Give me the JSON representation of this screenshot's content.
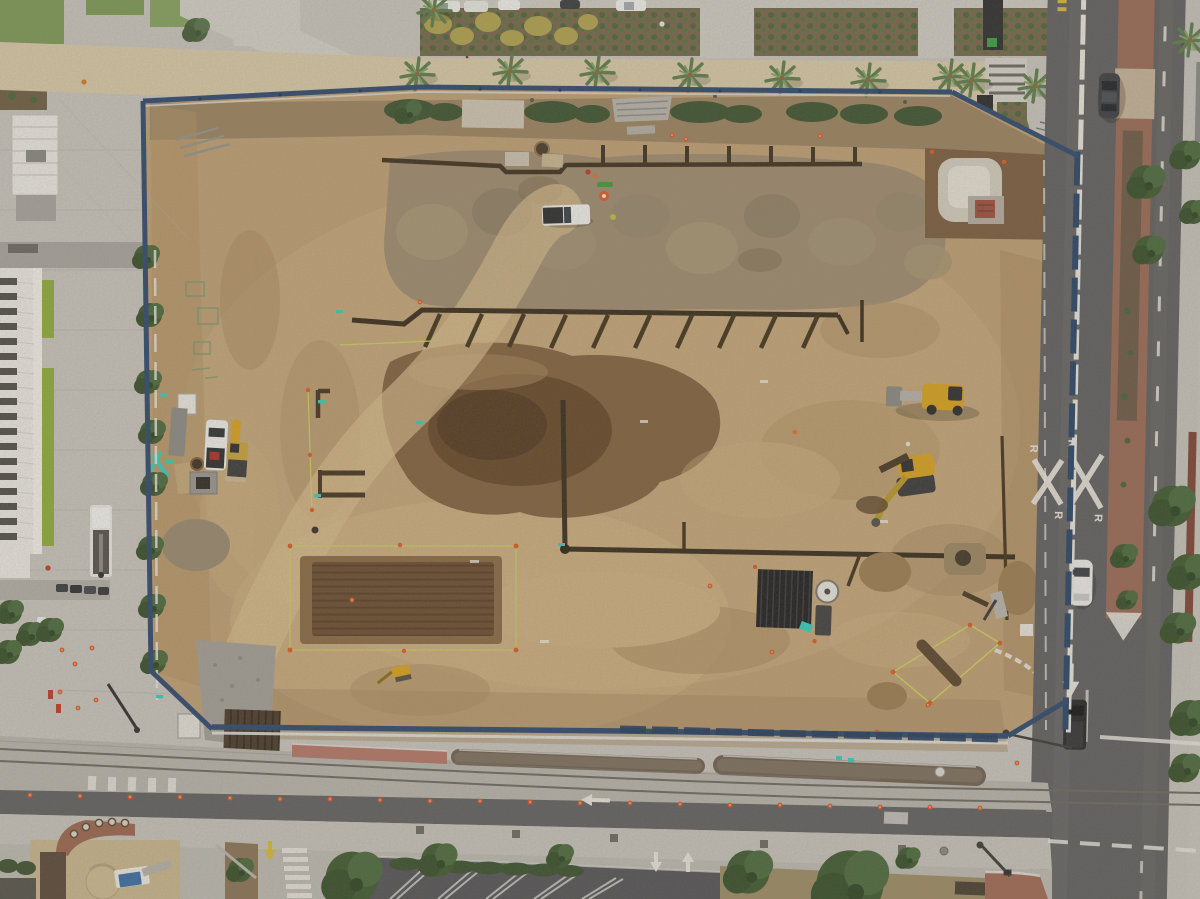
{
  "scene": {
    "title": "Aerial drone view of an urban construction excavation site",
    "description": "Top-down photo: a large graded dirt lot enclosed by a blue construction fence. A palm-lined paver promenade and garden beds run along the top, a concrete civic plaza with a white slatted-roof building sits on the left, a north-south street with a red brick median runs down the right side, and a light-rail track corridor with a parallel roadway crosses the bottom. Excavators, trenches with soldier piles, spoil piles, survey string lines and scattered equipment cover the site.",
    "markings": {
      "railroad_crossing_letter": "R"
    },
    "palette": {
      "dirt": "#bfa076",
      "dirt_dark": "#7a5b3c",
      "pit": "#6b4e33",
      "plaza_concrete": "#c8c6c0",
      "paver_tan": "#d9cbab",
      "asphalt": "#616163",
      "brick_median": "#9a6a58",
      "pink_pavers": "#b5786b",
      "fence_blue": "#2e4a72",
      "barrier_white": "#e9e7e1",
      "track_concrete": "#b7b5af",
      "grass": "#7c9a58",
      "hedge": "#3d5432",
      "palm": "#6f8f5f",
      "machine_yellow": "#d9a322",
      "cone_orange": "#e05a28",
      "teal_marker": "#35cfc0",
      "survey_yellow": "#ccd25e",
      "tan_building": "#c9b691"
    },
    "counts": {
      "palm_trees": 10,
      "construction_machines": 4,
      "street_vehicles": 3,
      "parked_cars": 5,
      "perimeter_trees": 9
    },
    "objects": [
      "excavation-site",
      "perimeter-fence",
      "soldier-pile-trench",
      "utility-trench",
      "spoil-piles",
      "rect-excavation-pit",
      "survey-string",
      "gravel-pad",
      "timber-mats",
      "lagging-stack",
      "wheel-loader",
      "mini-excavator",
      "tracked-excavator",
      "white-pickup",
      "boom-truck",
      "palm-promenade",
      "garden-beds",
      "city-plaza",
      "white-building",
      "round-window-building",
      "light-rail-tracks",
      "median-planter",
      "brick-median",
      "rxr-marking",
      "crosswalk",
      "traffic-cones",
      "parking-lot",
      "street-trees",
      "intersection",
      "sedan",
      "white-car",
      "black-truck"
    ]
  }
}
